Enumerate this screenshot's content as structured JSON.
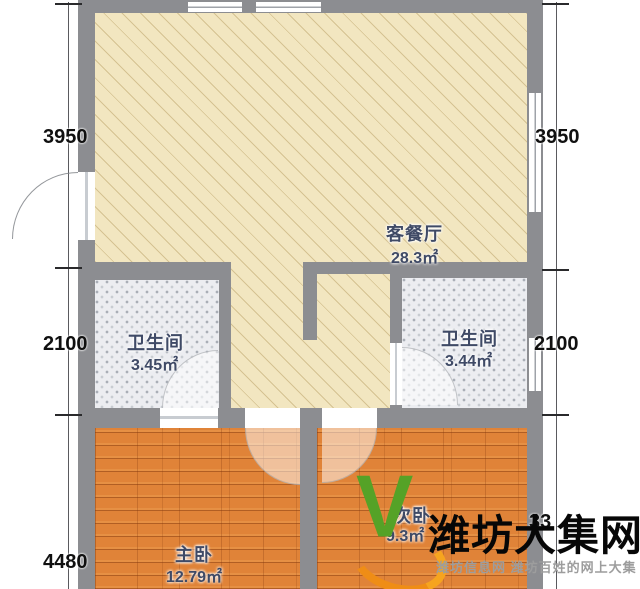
{
  "rooms": {
    "living": {
      "label": "客餐厅",
      "area": "28.3㎡"
    },
    "bath_left": {
      "label": "卫生间",
      "area": "3.45㎡"
    },
    "bath_right": {
      "label": "卫生间",
      "area": "3.44㎡"
    },
    "master": {
      "label": "主卧",
      "area": "12.79㎡"
    },
    "second": {
      "label": "次卧",
      "area": "9.3㎡"
    }
  },
  "dimensions": {
    "left_top": "3950",
    "left_middle": "2100",
    "left_bottom": "4480",
    "right_top": "3950",
    "right_middle": "2100",
    "right_bottom_partial": "33"
  },
  "watermark": {
    "logo_letter": "V",
    "title": "潍坊大集网",
    "subtitle": "潍坊信息网 潍坊百姓的网上大集"
  },
  "colors": {
    "wall": "#8c8d91",
    "living_floor": "#f2e6c0",
    "bath_floor": "#ecedf1",
    "wood_floor": "#e08338",
    "label_text": "#3f4a66",
    "dimension_text": "#101010",
    "watermark_green": "#55a227",
    "watermark_orange": "#ef8d16"
  }
}
